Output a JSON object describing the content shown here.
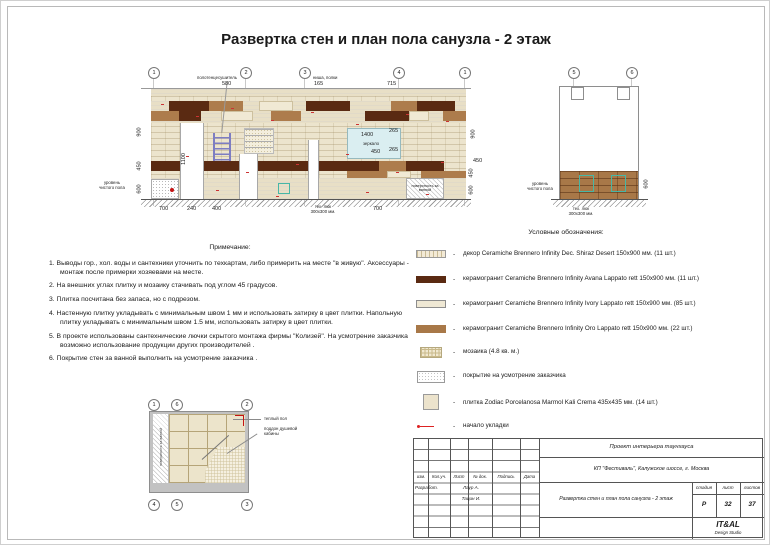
{
  "sheet": {
    "title": "Развертка стен и план пола санузла - 2 этаж"
  },
  "axes": {
    "elev": [
      "1",
      "2",
      "3",
      "4",
      "1"
    ],
    "sect": [
      "5",
      "6"
    ],
    "p_top": [
      "1",
      "6",
      "2"
    ],
    "p_bot": [
      "4",
      "5",
      "3"
    ]
  },
  "elevation": {
    "dims": {
      "top1": "580",
      "top2": "165",
      "top3": "715",
      "bot1": "700",
      "bot2": "240",
      "bot3": "400",
      "bot4": "700",
      "l1": "900",
      "l2": "450",
      "l3": "600",
      "r1": "900",
      "r2": "450",
      "r3": "450",
      "r4": "600",
      "door": "1100",
      "mirror_w": "1400",
      "mirror_r1": "265",
      "mirror_h": "450",
      "mirror_r2": "265"
    },
    "labels": {
      "towel": "полотенцесушитель",
      "niche": "ниша, полки",
      "mirror": "зеркало",
      "floor": "уровень чистого пола",
      "behind_bath": "поверхность за ванной",
      "hatch1": "тех. люк",
      "hatch2": "300х300 мм."
    }
  },
  "section": {
    "dim": "600",
    "floor": "уровень чистого пола",
    "hatch1": "тех. люк",
    "hatch2": "300х300 мм."
  },
  "plan": {
    "behind_bath": "поверхность за ванной",
    "warm_floor": "теплый пол",
    "shower": "поддон душевой кабины"
  },
  "legend": {
    "title": "Условные обозначения:",
    "dash": "-",
    "items": [
      {
        "text": "декор Ceramiche Brennero Infinity Dec. Shiraz Desert 150x900 мм. (11 шт.)"
      },
      {
        "text": "керамогранит Ceramiche Brennero Infinity Avana Lappato rett 150x900 мм. (11 шт.)"
      },
      {
        "text": "керамогранит Ceramiche Brennero Infinity Ivory Lappato rett 150x900 мм. (85 шт.)"
      },
      {
        "text": "керамогранит Ceramiche Brennero Infinity Oro Lappato rett 150x900 мм. (22 шт.)"
      },
      {
        "text": "мозаика (4.8 кв. м.)"
      },
      {
        "text": "покрытие на усмотрение заказчика"
      },
      {
        "text": "плитка Zodiac Porcelanosa Marmol Kali Crema  435х435 мм. (14 шт.)"
      },
      {
        "text": "начало укладки"
      }
    ]
  },
  "notes": {
    "title": "Примечание:",
    "items": [
      "1. Выводы гор., хол. воды и сантехники уточнить по техкартам, либо примерить на месте \"в живую\". Аксессуары - монтаж после примерки хозяевами на месте.",
      "2. На внешних углах плитку и мозаику стачивать под углом  45 градусов.",
      "3. Плитка посчитана без запаса, но с подрезом.",
      "4. Настенную плитку укладывать с минимальным швом  1 мм и использовать затирку в цвет плитки. Напольную плитку укладывать с минимальным швом  1.5 мм, использовать затирку в цвет плитки.",
      "5. В проекте использованы сантехнические лючки скрытого монтажа фирмы  \"Колизей\". На усмотрение заказчика возможно использование продукции других производителей .",
      "6. Покрытие стен за ванной выполнить на усмотрение заказчика ."
    ]
  },
  "titleblock": {
    "project": "Проект интерьера таунхауса",
    "address": "КП \"Фестиваль\", Калужское шоссе, г. Москва",
    "drawing": "Развертка стен и план пола санузла - 2 этаж",
    "col1": "изм.",
    "col2": "Кол.уч.",
    "col3": "Лист",
    "col4": "№ док.",
    "col5": "Подпись",
    "col6": "Дата",
    "row_dev": "Разработ.",
    "name1": "Лаур А.",
    "name2": "Тацин И.",
    "stage_h": "стадия",
    "sheet_h": "лист",
    "sheets_h": "листов",
    "stage": "Р",
    "sheet_no": "32",
    "sheets_total": "37",
    "studio": "IT&AL",
    "studio_sub": "Design Studio"
  }
}
